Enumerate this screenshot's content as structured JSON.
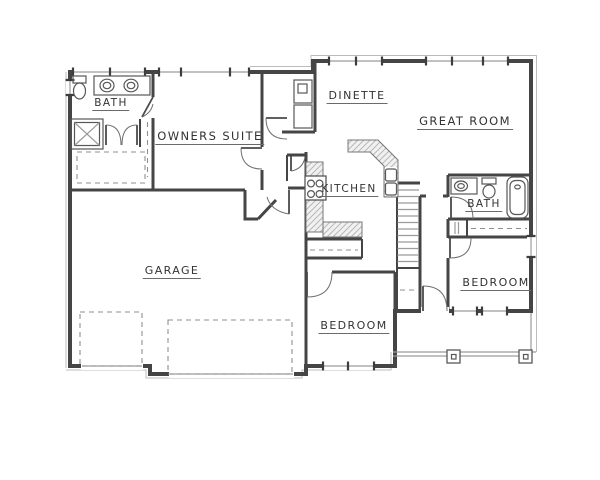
{
  "title": "single-story floor plan",
  "rooms": [
    {
      "id": "bath-1",
      "label": "BATH"
    },
    {
      "id": "owners-suite",
      "label": "OWNERS SUITE"
    },
    {
      "id": "dinette",
      "label": "DINETTE"
    },
    {
      "id": "great-room",
      "label": "GREAT ROOM"
    },
    {
      "id": "kitchen",
      "label": "KITCHEN"
    },
    {
      "id": "bath-2",
      "label": "BATH"
    },
    {
      "id": "garage",
      "label": "GARAGE"
    },
    {
      "id": "bedroom-1",
      "label": "BEDROOM"
    },
    {
      "id": "bedroom-2",
      "label": "BEDROOM"
    }
  ],
  "colors": {
    "wall": "#454545",
    "window_glass": "#a9aeb1",
    "hatch": "#b8b8b8",
    "dashed_line": "#8f8f8f",
    "ink": "#333333",
    "background": "#ffffff"
  }
}
